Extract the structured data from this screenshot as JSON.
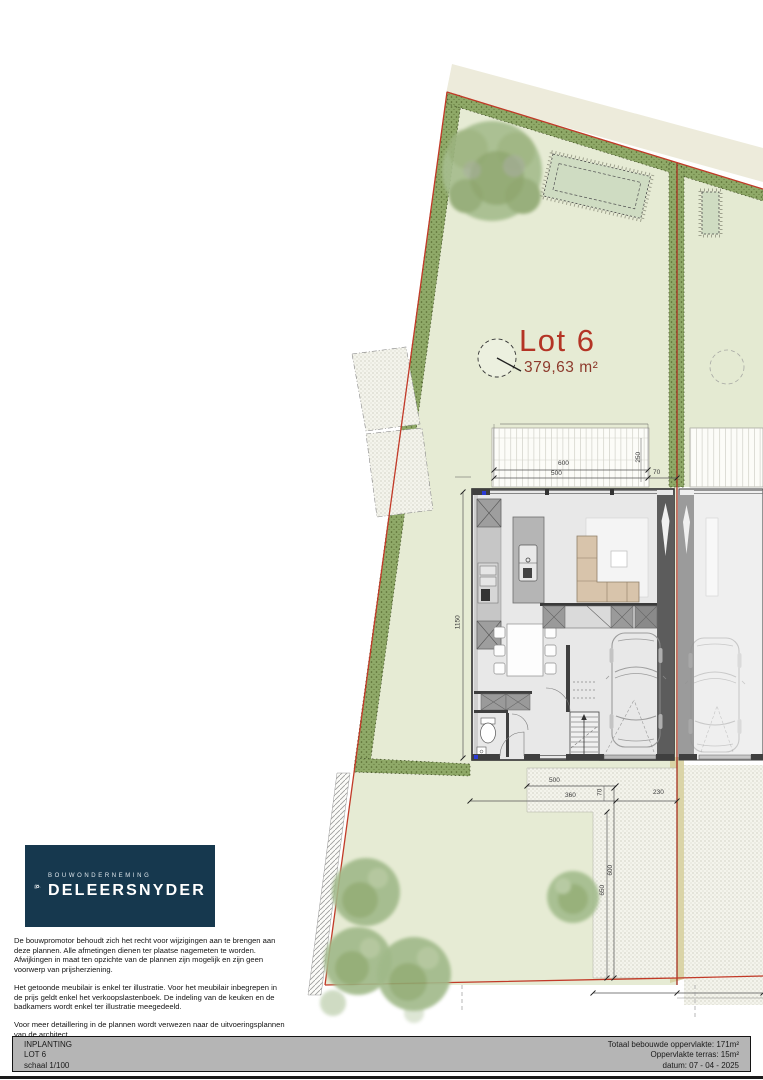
{
  "site_plan": {
    "lot_label": "Lot 6",
    "lot_area": "379,63 m²",
    "dimensions": {
      "terrace_width": "600",
      "terrace_width_inner": "500",
      "terrace_depth": "250",
      "side_strip": "70",
      "house_depth": "1150",
      "front_width": "500",
      "front_path": "360",
      "front_strip": "70",
      "front_side": "230",
      "garden_depth_a": "650",
      "garden_depth_b": "600"
    }
  },
  "logo": {
    "tagline": "BOUWONDERNEMING",
    "name": "DELEERSNYDER"
  },
  "disclaimer": {
    "p1": "De bouwpromotor behoudt zich het recht voor wijzigingen aan te brengen aan deze plannen. Alle afmetingen dienen ter plaatse nagemeten te worden. Afwijkingen in maat ten opzichte van de plannen zijn mogelijk en zijn geen voorwerp van prijsherziening.",
    "p2": "Het getoonde meubilair is enkel ter illustratie. Voor het meubilair inbegrepen in de prijs geldt enkel het verkoopslastenboek. De indeling van de keuken en de badkamers wordt enkel ter illustratie meegedeeld.",
    "p3": "Voor meer detaillering in de plannen wordt verwezen naar de uitvoeringsplannen van de architect."
  },
  "title_block": {
    "left": [
      "INPLANTING",
      "LOT 6",
      "schaal 1/100"
    ],
    "right": [
      "Totaal bebouwde oppervlakte: 171m²",
      "Oppervlakte terras: 15m²",
      "datum: 07 - 04 - 2025"
    ]
  },
  "colors": {
    "lot_fill": "#e6ebd4",
    "hedge_green": "#8fa968",
    "boundary_red": "#c23a28",
    "lot_text_red": "#b43425",
    "logo_navy": "#16384e",
    "titlebar_gray": "#b5b5b5"
  }
}
